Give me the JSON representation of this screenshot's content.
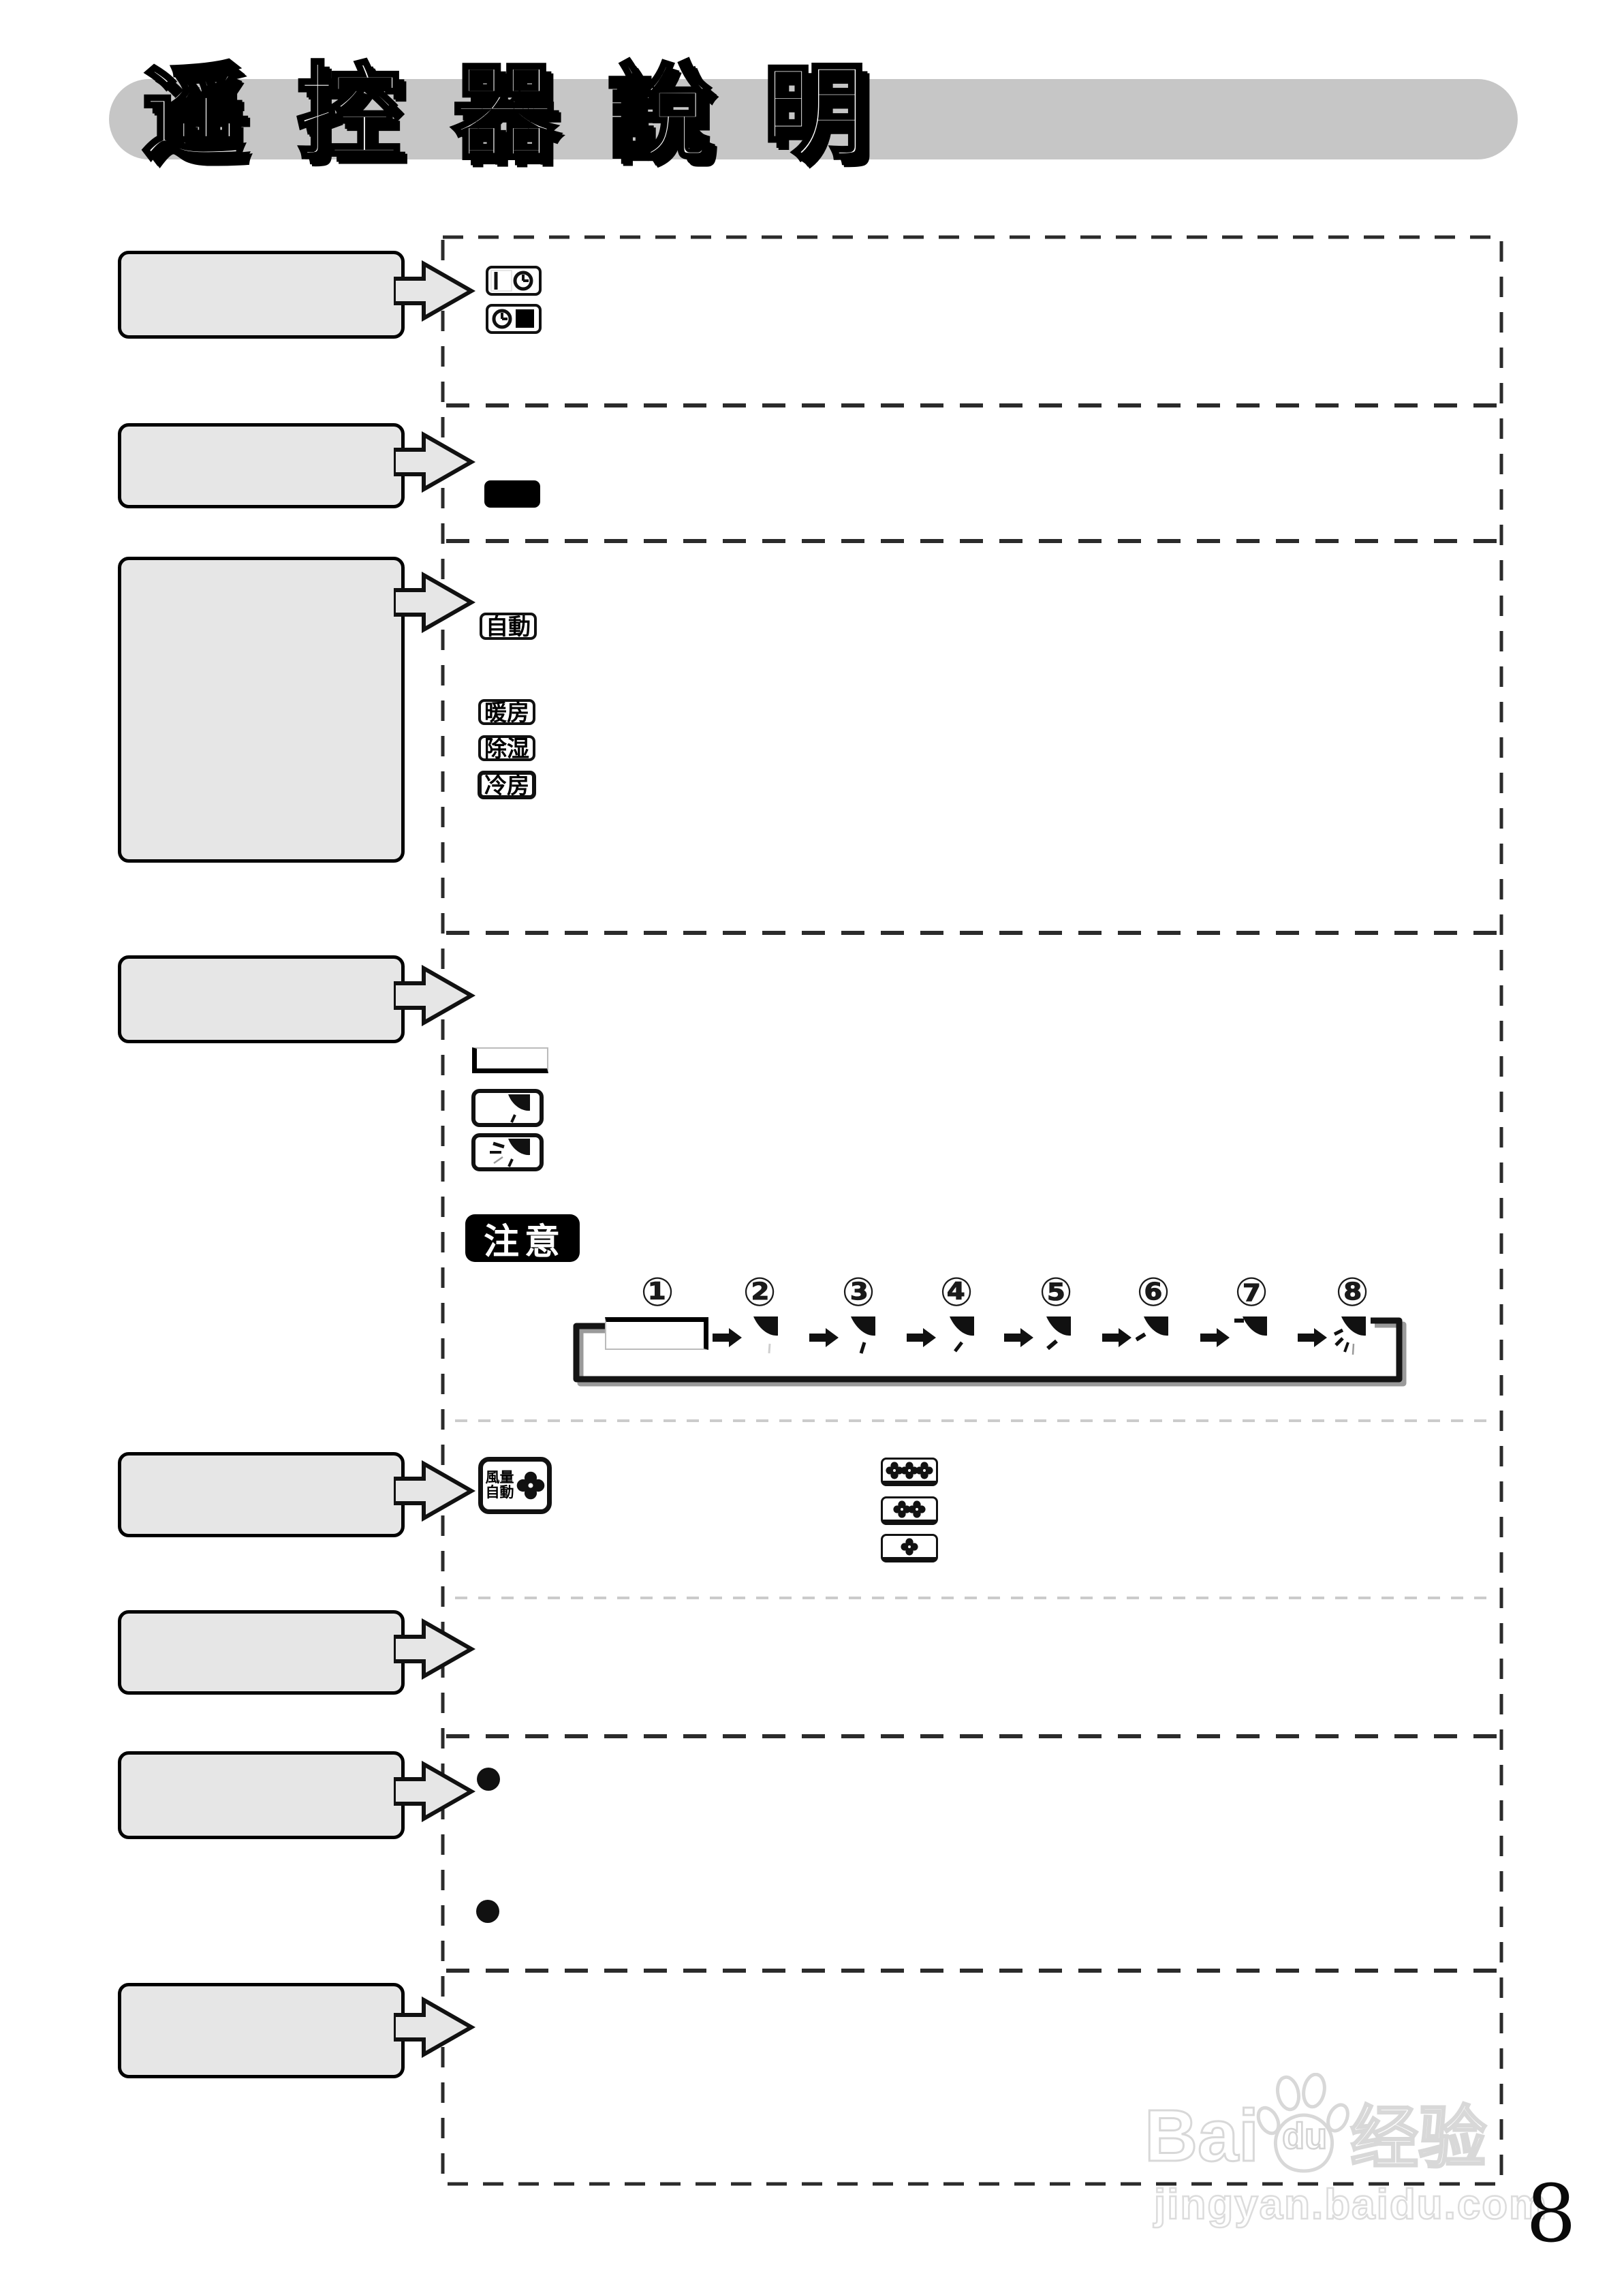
{
  "page": {
    "title": "遥控器說明",
    "number": "8"
  },
  "notice": {
    "label": "注意"
  },
  "modes": {
    "items": [
      {
        "label": "自動"
      },
      {
        "label": "暖房"
      },
      {
        "label": "除湿"
      },
      {
        "label": "冷房"
      }
    ]
  },
  "fan": {
    "button_line1": "風量",
    "button_line2": "自動"
  },
  "sequence": {
    "steps": [
      {
        "num": "①"
      },
      {
        "num": "②"
      },
      {
        "num": "③"
      },
      {
        "num": "④"
      },
      {
        "num": "⑤"
      },
      {
        "num": "⑥"
      },
      {
        "num": "⑦"
      },
      {
        "num": "⑧"
      }
    ]
  },
  "watermark": {
    "brand_prefix": "Bai",
    "brand_paw_text": "du",
    "brand_suffix": "经验",
    "site": "jingyan.baidu.com"
  },
  "icons": {
    "timer_on_button": "bar-and-clock",
    "timer_off_button": "clock-and-filled-square",
    "power_button": "solid-black-rounded-rect",
    "vane_step": "louver-flap",
    "swing": "louver-flap-with-rays",
    "fan_speed": "four-petal-fan"
  },
  "colors": {
    "banner_gray": "#c6c6c6",
    "callout_gray": "#e6e6e6",
    "line_black": "#2b2b2b",
    "line_light": "#cbcbcb",
    "watermark_gray": "#d8d8d8"
  }
}
